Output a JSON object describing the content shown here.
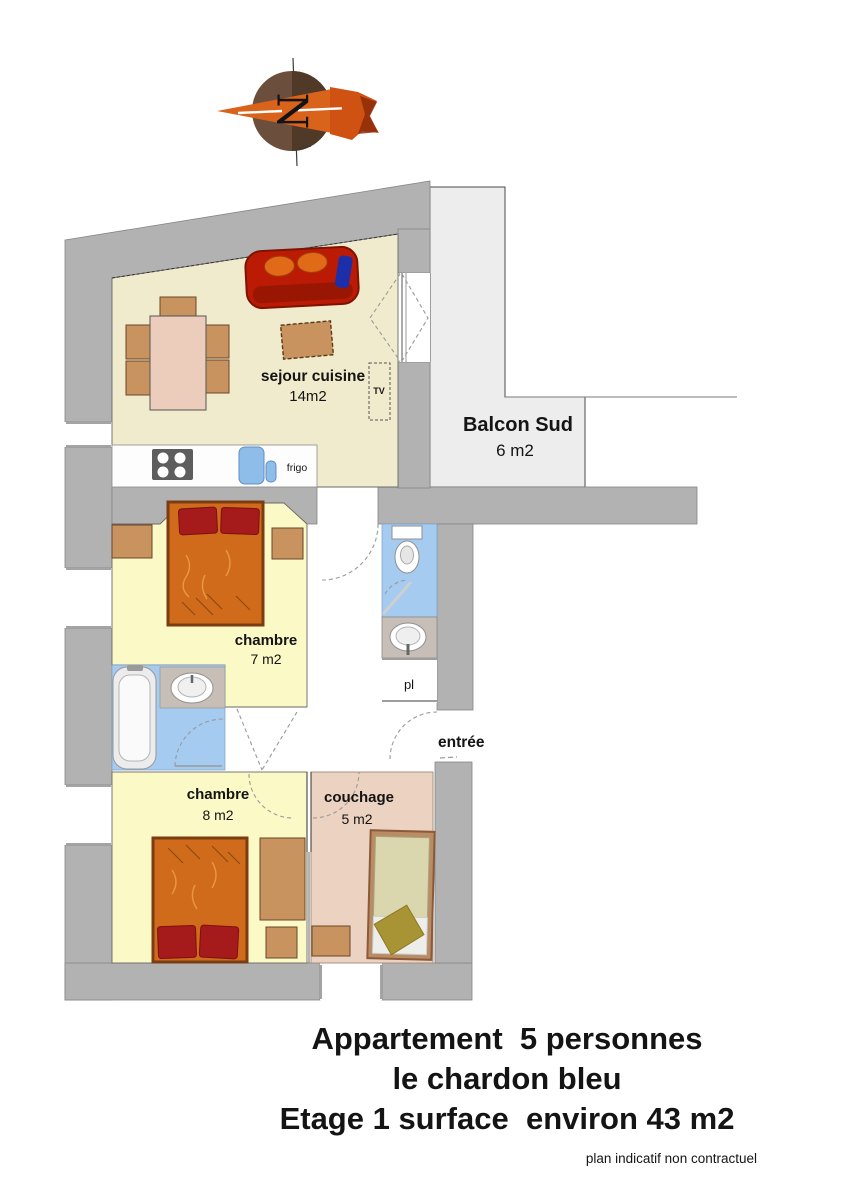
{
  "plan": {
    "compass": {
      "north": "N"
    },
    "rooms": {
      "sejour": {
        "name": "sejour cuisine",
        "area": "14m2"
      },
      "balcon": {
        "name": "Balcon Sud",
        "area": "6 m2"
      },
      "chambre7": {
        "name": "chambre",
        "area": "7 m2"
      },
      "chambre8": {
        "name": "chambre",
        "area": "8 m2"
      },
      "couchage": {
        "name": "couchage",
        "area": "5 m2"
      }
    },
    "labels": {
      "frigo": "frigo",
      "tv": "TV",
      "pl": "pl",
      "entree": "entrée"
    }
  },
  "title": {
    "line1": "Appartement  5 personnes",
    "line2": "le chardon bleu",
    "line3": "Etage 1 surface  environ 43 m2"
  },
  "footer": "plan indicatif non contractuel",
  "colors": {
    "wall": "#b2b2b2",
    "balcony": "#ededed",
    "sejour_floor": "#f1ebcd",
    "bedroom_floor": "#fbf9c5",
    "couchage_floor": "#ecd2c0",
    "wet_floor": "#a5cbf1",
    "counter": "#fdfdfd",
    "bed": "#cf6b1b",
    "pillow": "#a51a1a",
    "sofa": "#bb1b05",
    "wood": "#c8935e",
    "table": "#ecccbb",
    "sink_blue": "#8fbde9",
    "compass_brown": "#6b4e3b",
    "compass_orange": "#d9631a"
  }
}
